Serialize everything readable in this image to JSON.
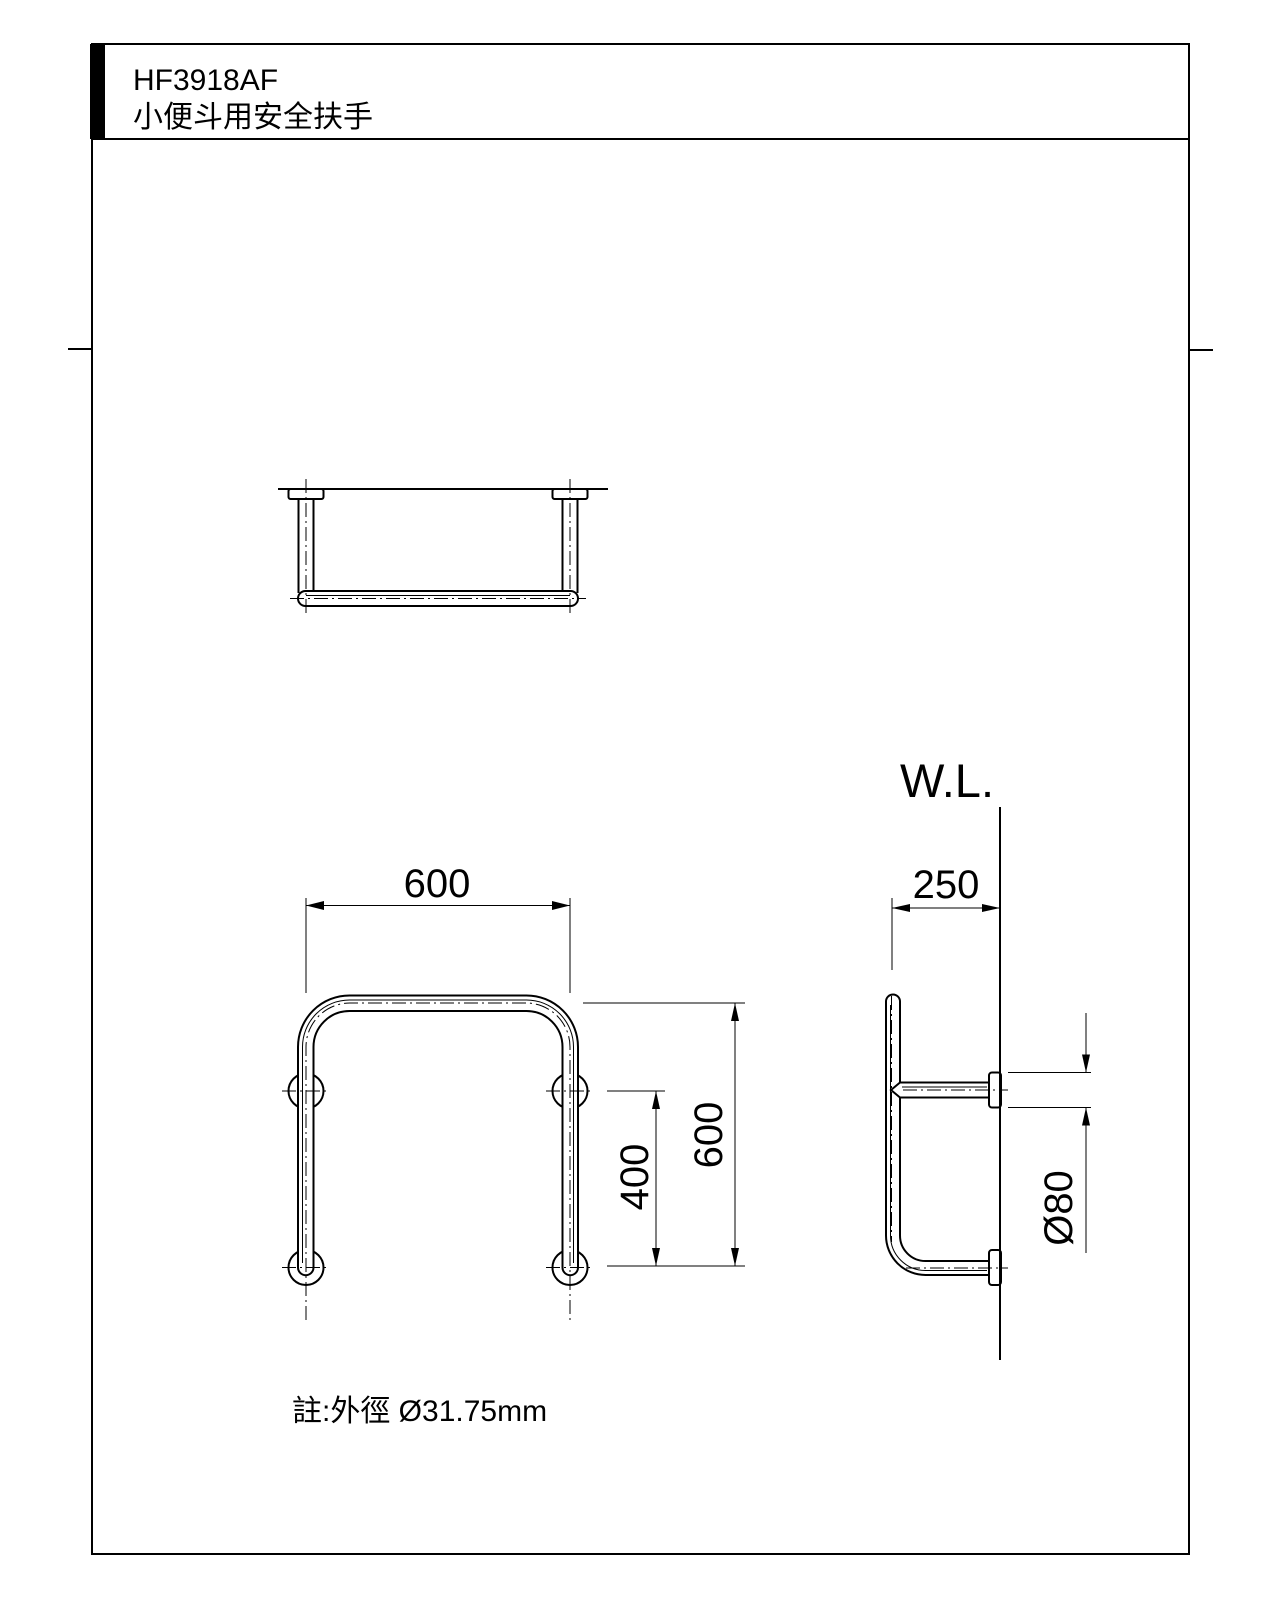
{
  "drawing": {
    "model": "HF3918AF",
    "product_name": "小便斗用安全扶手",
    "note": "註:外徑 Ø31.75mm",
    "labels": {
      "water_line": "W.L.",
      "front_width": "600",
      "front_lower_height": "400",
      "front_total_height": "600",
      "side_depth": "250",
      "flange_diameter": "Ø80"
    },
    "colors": {
      "line": "#000000",
      "background": "#ffffff"
    }
  }
}
